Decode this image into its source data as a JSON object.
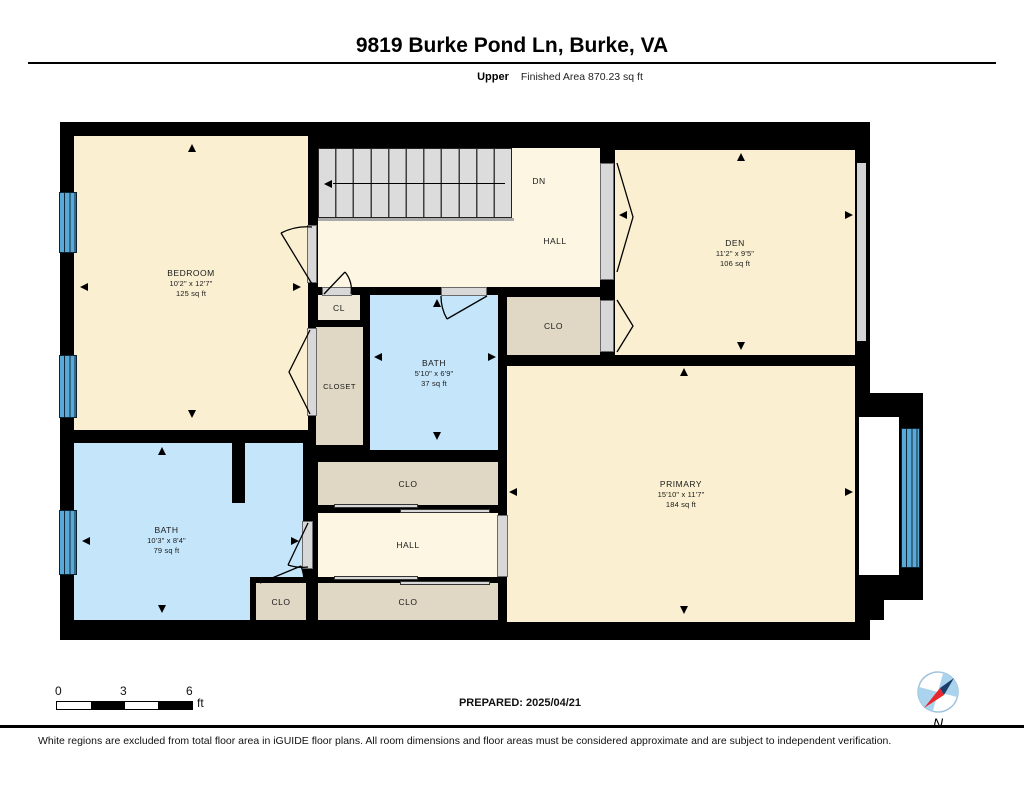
{
  "header": {
    "title": "9819 Burke Pond Ln, Burke, VA",
    "floor_label": "Upper",
    "area_label": "Finished Area 870.23 sq ft"
  },
  "rooms": {
    "bedroom": {
      "name": "BEDROOM",
      "dims": "10'2\" x 12'7\"",
      "area": "125 sq ft"
    },
    "den": {
      "name": "DEN",
      "dims": "11'2\" x 9'5\"",
      "area": "106 sq ft"
    },
    "bath_upper": {
      "name": "BATH",
      "dims": "5'10\" x 6'9\"",
      "area": "37 sq ft"
    },
    "primary": {
      "name": "PRIMARY",
      "dims": "15'10\" x 11'7\"",
      "area": "184 sq ft"
    },
    "bath_lower": {
      "name": "BATH",
      "dims": "10'3\" x 8'4\"",
      "area": "79 sq ft"
    },
    "hall_upper": {
      "name": "HALL"
    },
    "hall_lower": {
      "name": "HALL"
    },
    "cl": {
      "name": "CL"
    },
    "closet": {
      "name": "CLOSET"
    },
    "clo_mid": {
      "name": "CLO"
    },
    "clo_hall_upper": {
      "name": "CLO"
    },
    "clo_hall_lower": {
      "name": "CLO"
    },
    "clo_small": {
      "name": "CLO"
    },
    "stair_direction": "DN"
  },
  "scale_bar": {
    "ticks": [
      "0",
      "3",
      "6"
    ],
    "unit": "ft"
  },
  "prepared_label": "PREPARED: 2025/04/21",
  "compass": {
    "north_label": "N"
  },
  "disclaimer": "White regions are excluded from total floor area in iGUIDE floor plans. All room dimensions and floor areas must be considered approximate and are subject to independent verification.",
  "colors": {
    "room_fill": "#FAEFD1",
    "hall_fill": "#FCF6E2",
    "closet_fill": "#E1D7C5",
    "bath_fill": "#C5E6FA",
    "window_blue": "#58A9D7",
    "wall": "#000000",
    "stairs": "#DCDCDC",
    "compass_red": "#E8262D",
    "compass_blue": "#AAD4EE"
  }
}
